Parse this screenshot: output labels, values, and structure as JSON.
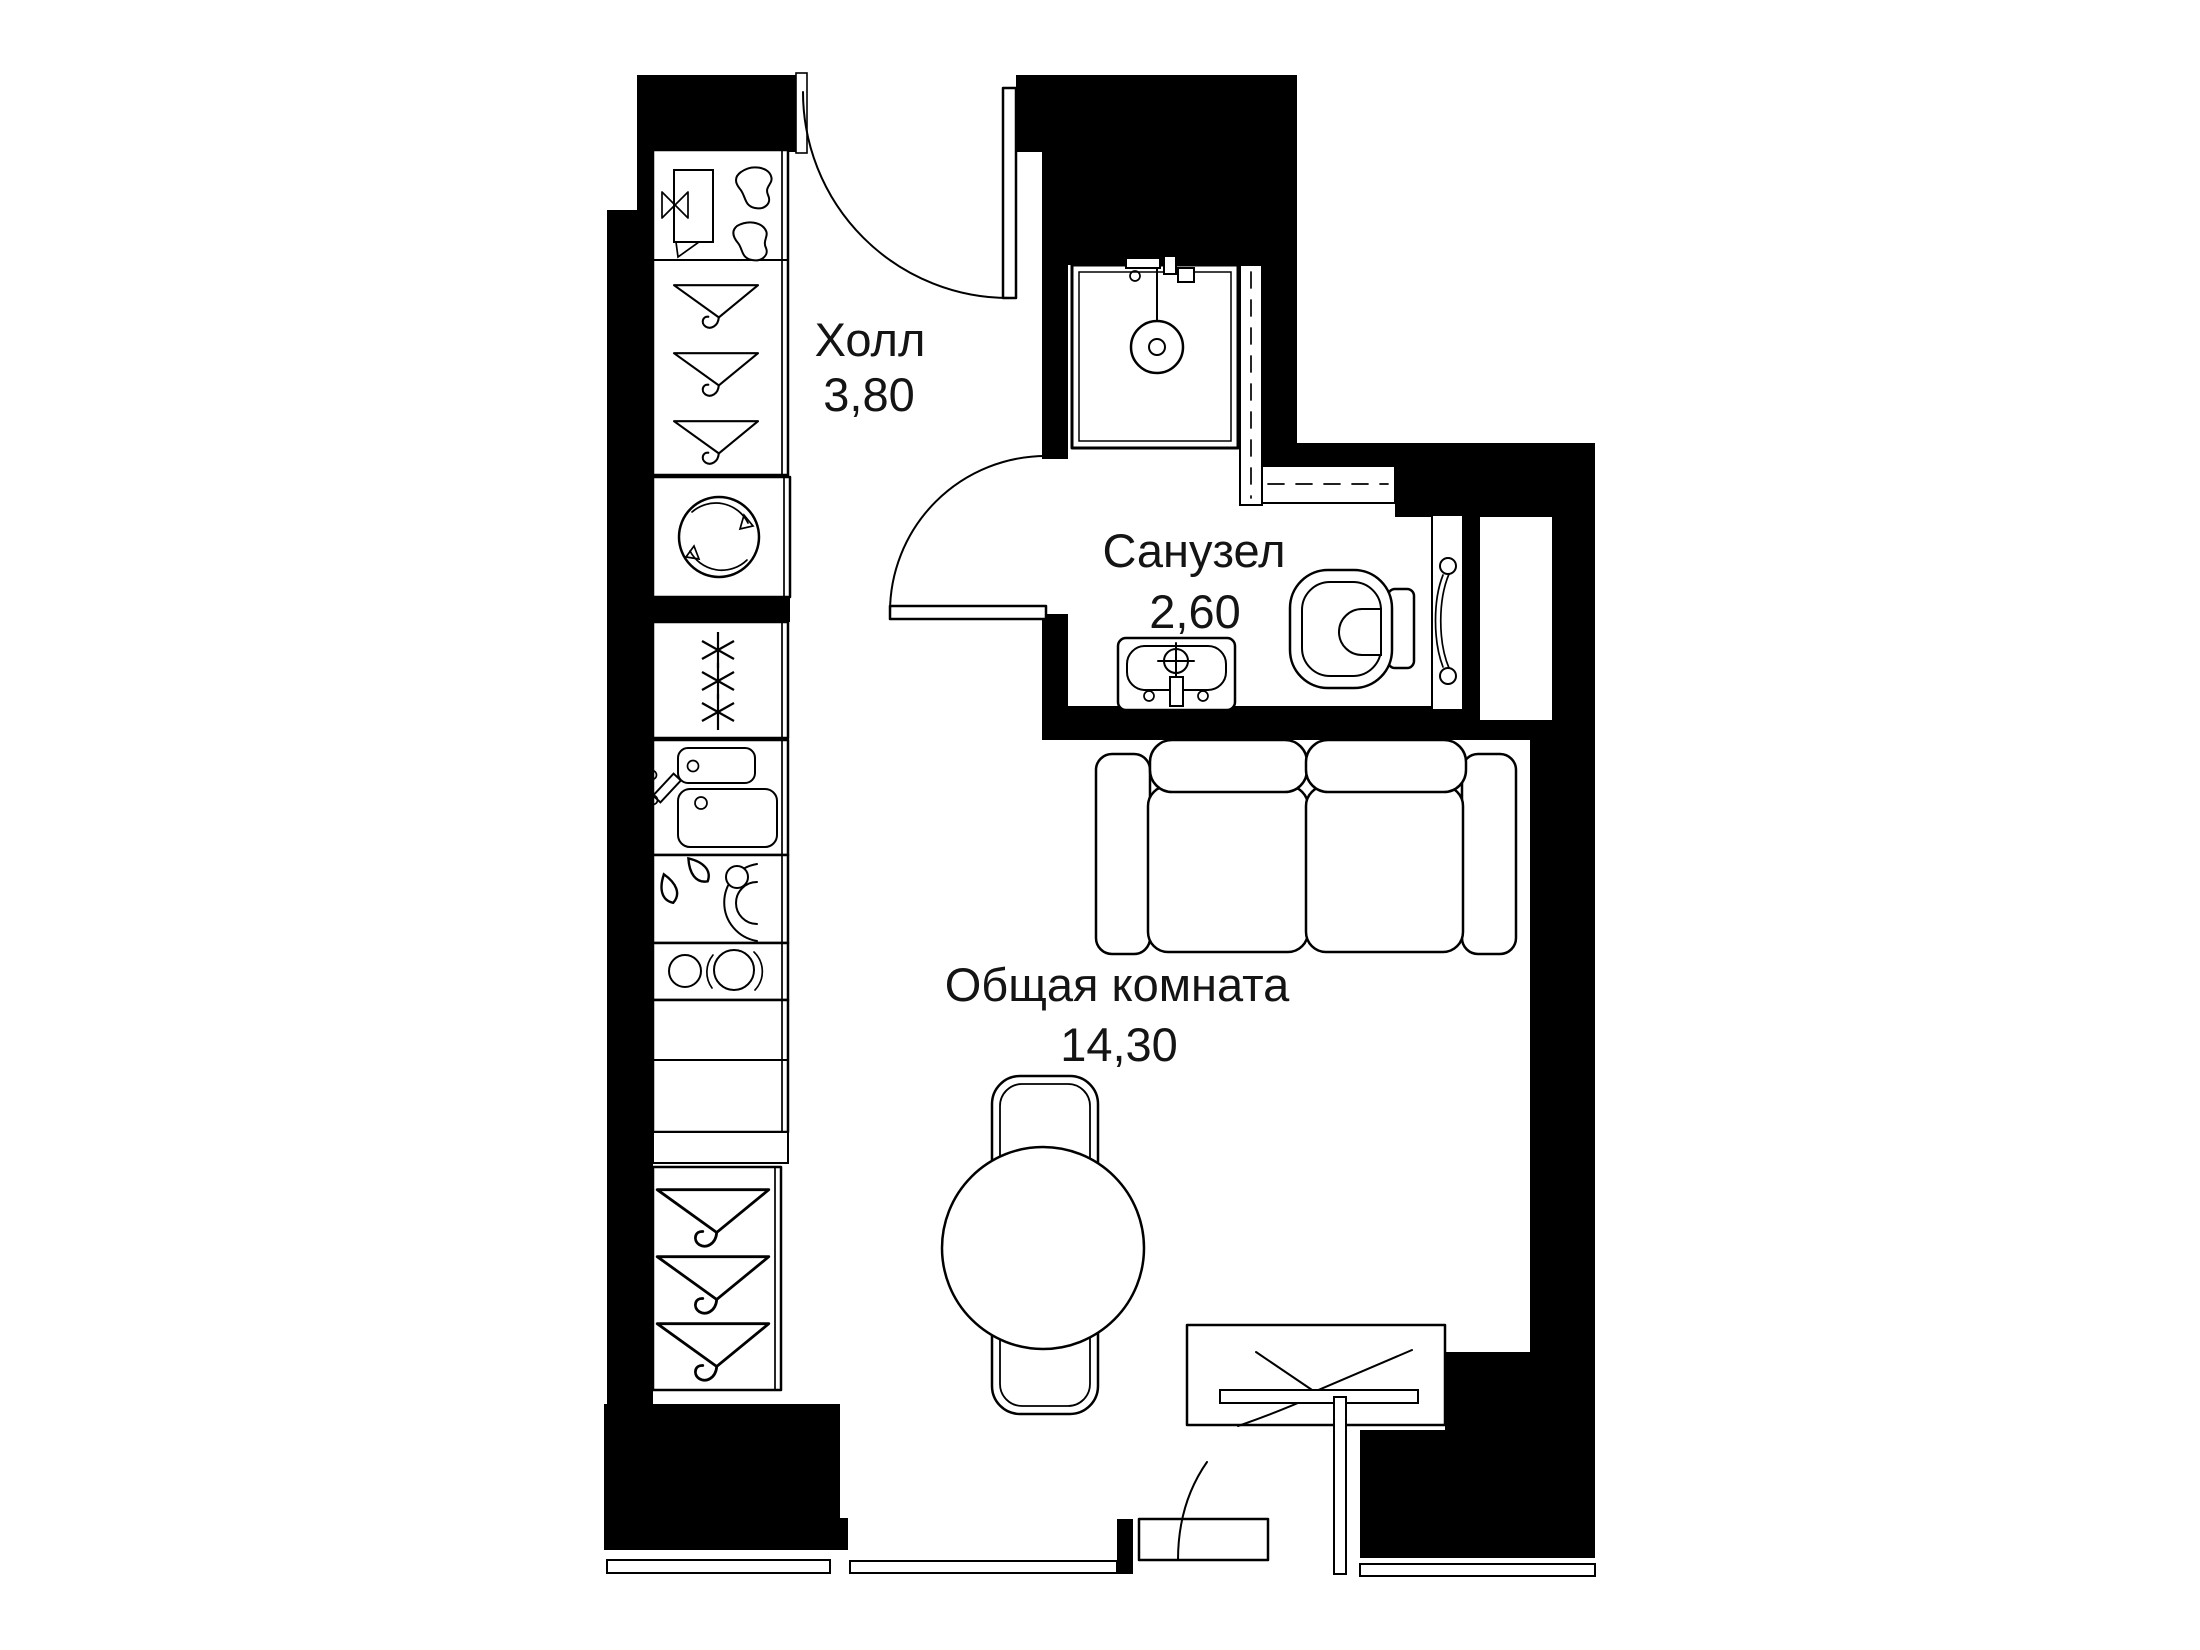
{
  "page": {
    "background": "#ffffff"
  },
  "colors": {
    "wall": "#000000",
    "line": "#000000",
    "text": "#141414"
  },
  "rooms": [
    {
      "id": "hall",
      "label": "Холл",
      "area": "3,80"
    },
    {
      "id": "bathroom",
      "label": "Санузел",
      "area": "2,60"
    },
    {
      "id": "living-room",
      "label": "Общая комната",
      "area": "14,30"
    }
  ],
  "fixtures": [
    "entrance-door",
    "wardrobe-hangers",
    "shoe-rack",
    "washing-machine",
    "refrigerator",
    "kitchen-sink",
    "dishwasher",
    "cooktop",
    "kitchen-cabinet",
    "shower-cabin",
    "washbasin",
    "toilet",
    "towel-rail",
    "vent-shaft",
    "sofa",
    "dining-table",
    "dining-chair",
    "desk",
    "window",
    "balcony-door"
  ]
}
